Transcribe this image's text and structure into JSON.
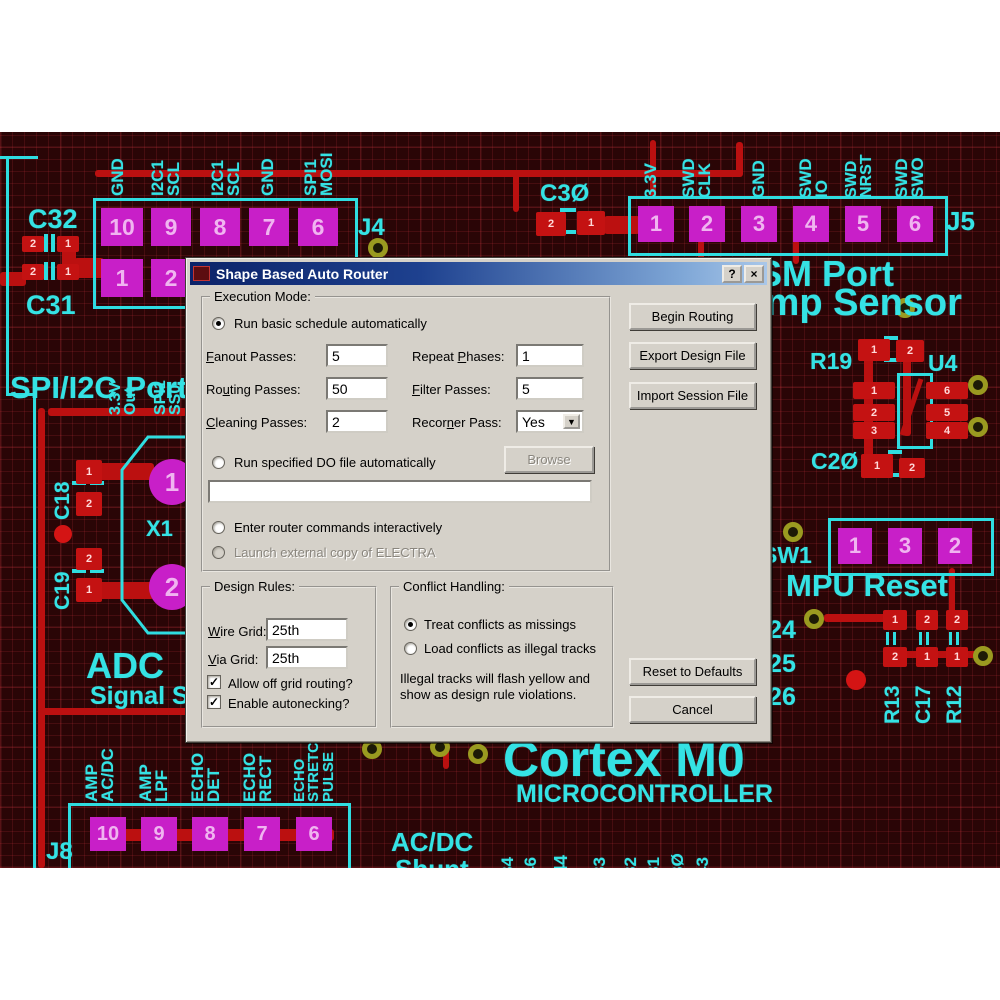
{
  "dialog": {
    "title": "Shape Based Auto Router",
    "help_glyph": "?",
    "close_glyph": "×",
    "check_glyph": "✓",
    "arrow_glyph": "▼",
    "exec": {
      "legend": "Execution Mode:",
      "radio_basic": "Run basic schedule automatically",
      "basic_selected": true,
      "fanout_label": "&Fanout Passes:",
      "fanout_value": "5",
      "repeat_label": "Repeat &Phases:",
      "repeat_value": "1",
      "routing_label": "Ro&uting Passes:",
      "routing_value": "50",
      "filter_label": "&Filter Passes:",
      "filter_value": "5",
      "cleaning_label": "&Cleaning Passes:",
      "cleaning_value": "2",
      "recorner_label": "Recor&ner Pass:",
      "recorner_value": "Yes",
      "radio_dofile": "Run specified DO file automatically",
      "dofile_selected": false,
      "browse_label": "Browse",
      "dofile_value": "",
      "radio_interactive": "Enter router commands interactively",
      "interactive_selected": false,
      "radio_electra": "Launch external copy of ELECTRA",
      "electra_selected": false
    },
    "design_rules": {
      "legend": "Design Rules:",
      "wire_label": "&Wire Grid:",
      "wire_value": "25th",
      "via_label": "&Via Grid:",
      "via_value": "25th",
      "offgrid_label": "Allow off grid routing?",
      "offgrid_checked": true,
      "autoneck_label": "Enable autonecking?",
      "autoneck_checked": true
    },
    "conflict": {
      "legend": "Conflict Handling:",
      "radio_missings": "Treat conflicts as missings",
      "missings_selected": true,
      "radio_illegal": "Load conflicts as illegal tracks",
      "illegal_selected": false,
      "note1": "Illegal tracks will flash yellow and",
      "note2": "show as design rule violations."
    },
    "buttons": {
      "begin": "Begin Routing",
      "export": "Export Design File",
      "import": "Import Session File",
      "reset": "Reset to Defaults",
      "cancel": "Cancel"
    }
  },
  "pcb": {
    "colors": {
      "board": "#2a0506",
      "silk": "#35e2e4",
      "pad": "#c81fc8",
      "copper": "#bb1010",
      "via_ring": "#9a9a20"
    },
    "labels": [
      {
        "t": "C32",
        "x": 28,
        "y": 74,
        "s": 27
      },
      {
        "t": "C31",
        "x": 26,
        "y": 160,
        "s": 27
      },
      {
        "t": "J4",
        "x": 358,
        "y": 84,
        "s": 24
      },
      {
        "t": "C3Ø",
        "x": 540,
        "y": 50,
        "s": 24
      },
      {
        "t": "J5",
        "x": 946,
        "y": 76,
        "s": 26
      },
      {
        "t": "GSM Port",
        "x": 730,
        "y": 124,
        "s": 36,
        "w": 900
      },
      {
        "t": "Temp Sensor",
        "x": 724,
        "y": 152,
        "s": 38,
        "w": 900
      },
      {
        "t": "R19",
        "x": 810,
        "y": 218,
        "s": 23
      },
      {
        "t": "U4",
        "x": 928,
        "y": 220,
        "s": 23
      },
      {
        "t": "C2Ø",
        "x": 811,
        "y": 318,
        "s": 23
      },
      {
        "t": "SW1",
        "x": 762,
        "y": 412,
        "s": 23
      },
      {
        "t": "MPU Reset",
        "x": 786,
        "y": 438,
        "s": 31,
        "w": 900
      },
      {
        "t": "C24",
        "x": 750,
        "y": 486,
        "s": 25
      },
      {
        "t": "C25",
        "x": 750,
        "y": 520,
        "s": 25
      },
      {
        "t": "C26",
        "x": 750,
        "y": 553,
        "s": 25
      },
      {
        "t": "SPI/I2C Port",
        "x": 10,
        "y": 240,
        "s": 31,
        "w": 900
      },
      {
        "t": "X1",
        "x": 146,
        "y": 386,
        "s": 22
      },
      {
        "t": "ADC",
        "x": 86,
        "y": 516,
        "s": 36,
        "w": 900
      },
      {
        "t": "Signal Source",
        "x": 90,
        "y": 552,
        "s": 25,
        "w": 900
      },
      {
        "t": "Cortex M0",
        "x": 503,
        "y": 602,
        "s": 50,
        "w": 900
      },
      {
        "t": "MICROCONTROLLER",
        "x": 516,
        "y": 650,
        "s": 25,
        "w": 900
      },
      {
        "t": "AC/DC",
        "x": 391,
        "y": 697,
        "s": 26,
        "w": 900
      },
      {
        "t": "Shunt",
        "x": 395,
        "y": 724,
        "s": 26,
        "w": 900
      },
      {
        "t": "J8",
        "x": 46,
        "y": 708,
        "s": 24
      }
    ],
    "vlabels": [
      {
        "t": "GND",
        "x": 110,
        "y": 64,
        "s": 17
      },
      {
        "t": "I2C1\nSCL",
        "x": 150,
        "y": 64,
        "s": 17
      },
      {
        "t": "I2C1\nSCL",
        "x": 210,
        "y": 64,
        "s": 17
      },
      {
        "t": "GND",
        "x": 260,
        "y": 64,
        "s": 17
      },
      {
        "t": "SPI1\nMOSI",
        "x": 303,
        "y": 64,
        "s": 17
      },
      {
        "t": "3.3V",
        "x": 643,
        "y": 66,
        "s": 17
      },
      {
        "t": "SWD\nCLK",
        "x": 681,
        "y": 66,
        "s": 17
      },
      {
        "t": "GND",
        "x": 751,
        "y": 66,
        "s": 17
      },
      {
        "t": "SWD\nIO",
        "x": 798,
        "y": 66,
        "s": 17
      },
      {
        "t": "SWD\nNRST",
        "x": 844,
        "y": 66,
        "s": 16
      },
      {
        "t": "SWD\nSWO",
        "x": 894,
        "y": 66,
        "s": 17
      },
      {
        "t": "3.3V\nOut",
        "x": 108,
        "y": 283,
        "s": 16
      },
      {
        "t": "SPI1\nSS0",
        "x": 153,
        "y": 283,
        "s": 16
      },
      {
        "t": "C18",
        "x": 53,
        "y": 388,
        "s": 21
      },
      {
        "t": "C19",
        "x": 53,
        "y": 478,
        "s": 21
      },
      {
        "t": "R13",
        "x": 883,
        "y": 592,
        "s": 21
      },
      {
        "t": "C17",
        "x": 914,
        "y": 592,
        "s": 21
      },
      {
        "t": "R12",
        "x": 945,
        "y": 592,
        "s": 21
      },
      {
        "t": "AMP\nAC/DC",
        "x": 84,
        "y": 670,
        "s": 17
      },
      {
        "t": "AMP\nLPF",
        "x": 138,
        "y": 670,
        "s": 17
      },
      {
        "t": "ECHO\nDET",
        "x": 190,
        "y": 670,
        "s": 17
      },
      {
        "t": "ECHO\nRECT",
        "x": 242,
        "y": 670,
        "s": 17
      },
      {
        "t": "ECHO\nSTRETCH\nPULSE",
        "x": 293,
        "y": 670,
        "s": 15
      },
      {
        "t": "34",
        "x": 500,
        "y": 744,
        "s": 17
      },
      {
        "t": "46",
        "x": 523,
        "y": 744,
        "s": 17
      },
      {
        "t": "C44",
        "x": 553,
        "y": 756,
        "s": 18
      },
      {
        "t": "33",
        "x": 592,
        "y": 744,
        "s": 17
      },
      {
        "t": "32",
        "x": 623,
        "y": 744,
        "s": 17
      },
      {
        "t": "31",
        "x": 646,
        "y": 744,
        "s": 17
      },
      {
        "t": "3Ø",
        "x": 670,
        "y": 744,
        "s": 17
      },
      {
        "t": "43",
        "x": 695,
        "y": 744,
        "s": 17
      }
    ],
    "pads": [
      {
        "t": "10",
        "x": 101,
        "y": 76,
        "w": 42,
        "h": 38
      },
      {
        "t": "9",
        "x": 151,
        "y": 76,
        "w": 40,
        "h": 38
      },
      {
        "t": "8",
        "x": 200,
        "y": 76,
        "w": 40,
        "h": 38
      },
      {
        "t": "7",
        "x": 249,
        "y": 76,
        "w": 40,
        "h": 38
      },
      {
        "t": "6",
        "x": 298,
        "y": 76,
        "w": 40,
        "h": 38
      },
      {
        "t": "1",
        "x": 101,
        "y": 127,
        "w": 42,
        "h": 38
      },
      {
        "t": "2",
        "x": 151,
        "y": 127,
        "w": 40,
        "h": 38
      },
      {
        "t": "1",
        "x": 638,
        "y": 74,
        "w": 36,
        "h": 36
      },
      {
        "t": "2",
        "x": 689,
        "y": 74,
        "w": 36,
        "h": 36
      },
      {
        "t": "3",
        "x": 741,
        "y": 74,
        "w": 36,
        "h": 36
      },
      {
        "t": "4",
        "x": 793,
        "y": 74,
        "w": 36,
        "h": 36
      },
      {
        "t": "5",
        "x": 845,
        "y": 74,
        "w": 36,
        "h": 36
      },
      {
        "t": "6",
        "x": 897,
        "y": 74,
        "w": 36,
        "h": 36
      },
      {
        "t": "1",
        "x": 838,
        "y": 396,
        "w": 34,
        "h": 36
      },
      {
        "t": "3",
        "x": 888,
        "y": 396,
        "w": 34,
        "h": 36
      },
      {
        "t": "2",
        "x": 938,
        "y": 396,
        "w": 34,
        "h": 36
      },
      {
        "t": "10",
        "x": 90,
        "y": 685,
        "w": 36,
        "h": 34
      },
      {
        "t": "9",
        "x": 141,
        "y": 685,
        "w": 36,
        "h": 34
      },
      {
        "t": "8",
        "x": 192,
        "y": 685,
        "w": 36,
        "h": 34
      },
      {
        "t": "7",
        "x": 244,
        "y": 685,
        "w": 36,
        "h": 34
      },
      {
        "t": "6",
        "x": 296,
        "y": 685,
        "w": 36,
        "h": 34
      }
    ],
    "circle_pads": [
      {
        "t": "1",
        "x": 172,
        "y": 350,
        "r": 23
      },
      {
        "t": "2",
        "x": 172,
        "y": 455,
        "r": 23
      }
    ],
    "red_pads": [
      {
        "t": "2",
        "x": 22,
        "y": 104,
        "w": 22,
        "h": 16
      },
      {
        "t": "1",
        "x": 57,
        "y": 104,
        "w": 22,
        "h": 16
      },
      {
        "t": "2",
        "x": 22,
        "y": 132,
        "w": 22,
        "h": 16
      },
      {
        "t": "1",
        "x": 57,
        "y": 132,
        "w": 22,
        "h": 16
      },
      {
        "t": "2",
        "x": 536,
        "y": 80,
        "w": 30,
        "h": 24
      },
      {
        "t": "1",
        "x": 577,
        "y": 79,
        "w": 28,
        "h": 24
      },
      {
        "t": "1",
        "x": 858,
        "y": 207,
        "w": 32,
        "h": 22
      },
      {
        "t": "2",
        "x": 896,
        "y": 208,
        "w": 28,
        "h": 22
      },
      {
        "t": "1",
        "x": 853,
        "y": 250,
        "w": 42,
        "h": 17
      },
      {
        "t": "2",
        "x": 853,
        "y": 272,
        "w": 42,
        "h": 17
      },
      {
        "t": "3",
        "x": 853,
        "y": 290,
        "w": 42,
        "h": 17
      },
      {
        "t": "6",
        "x": 926,
        "y": 250,
        "w": 42,
        "h": 17
      },
      {
        "t": "5",
        "x": 926,
        "y": 272,
        "w": 42,
        "h": 17
      },
      {
        "t": "4",
        "x": 926,
        "y": 290,
        "w": 42,
        "h": 17
      },
      {
        "t": "1",
        "x": 861,
        "y": 322,
        "w": 32,
        "h": 24
      },
      {
        "t": "2",
        "x": 899,
        "y": 326,
        "w": 26,
        "h": 20
      },
      {
        "t": "1",
        "x": 883,
        "y": 478,
        "w": 24,
        "h": 20
      },
      {
        "t": "2",
        "x": 916,
        "y": 478,
        "w": 22,
        "h": 20
      },
      {
        "t": "2",
        "x": 946,
        "y": 478,
        "w": 22,
        "h": 20
      },
      {
        "t": "2",
        "x": 883,
        "y": 515,
        "w": 24,
        "h": 20
      },
      {
        "t": "1",
        "x": 916,
        "y": 515,
        "w": 22,
        "h": 20
      },
      {
        "t": "1",
        "x": 946,
        "y": 515,
        "w": 22,
        "h": 20
      },
      {
        "t": "1",
        "x": 76,
        "y": 328,
        "w": 26,
        "h": 24
      },
      {
        "t": "2",
        "x": 76,
        "y": 360,
        "w": 26,
        "h": 24
      },
      {
        "t": "2",
        "x": 76,
        "y": 416,
        "w": 26,
        "h": 22
      },
      {
        "t": "1",
        "x": 76,
        "y": 446,
        "w": 26,
        "h": 24
      }
    ],
    "traces": [
      [
        95,
        38,
        647,
        7
      ],
      [
        736,
        10,
        7,
        35
      ],
      [
        513,
        38,
        6,
        42
      ],
      [
        62,
        112,
        14,
        24
      ],
      [
        74,
        126,
        30,
        20
      ],
      [
        0,
        140,
        26,
        14
      ],
      [
        604,
        84,
        36,
        18
      ],
      [
        698,
        108,
        6,
        20
      ],
      [
        793,
        108,
        6,
        24
      ],
      [
        650,
        8,
        6,
        58
      ],
      [
        864,
        223,
        9,
        102
      ],
      [
        903,
        214,
        8,
        90
      ],
      [
        949,
        436,
        6,
        48
      ],
      [
        824,
        482,
        64,
        8
      ],
      [
        883,
        519,
        100,
        7
      ],
      [
        48,
        276,
        139,
        8
      ],
      [
        38,
        276,
        7,
        460
      ],
      [
        38,
        576,
        165,
        7
      ],
      [
        98,
        331,
        56,
        17
      ],
      [
        98,
        450,
        56,
        17
      ],
      [
        90,
        697,
        244,
        12
      ],
      [
        443,
        611,
        6,
        26
      ]
    ],
    "outlines": [
      [
        93,
        66,
        259,
        105
      ],
      [
        628,
        64,
        314,
        54
      ],
      [
        828,
        386,
        160,
        52
      ],
      [
        68,
        671,
        277,
        80
      ],
      [
        897,
        241,
        30,
        70
      ]
    ],
    "cyan_marks": [
      [
        44,
        102,
        4,
        18
      ],
      [
        51,
        102,
        4,
        18
      ],
      [
        44,
        130,
        4,
        18
      ],
      [
        51,
        130,
        4,
        18
      ],
      [
        560,
        76,
        16,
        4
      ],
      [
        560,
        98,
        16,
        4
      ],
      [
        884,
        204,
        14,
        4
      ],
      [
        884,
        226,
        14,
        4
      ],
      [
        888,
        318,
        14,
        4
      ],
      [
        888,
        341,
        14,
        4
      ],
      [
        72,
        349,
        14,
        4
      ],
      [
        90,
        349,
        14,
        4
      ],
      [
        72,
        437,
        14,
        4
      ],
      [
        90,
        437,
        14,
        4
      ],
      [
        886,
        500,
        3,
        13
      ],
      [
        893,
        500,
        3,
        13
      ],
      [
        919,
        500,
        3,
        13
      ],
      [
        926,
        500,
        3,
        13
      ],
      [
        949,
        500,
        3,
        13
      ],
      [
        956,
        500,
        3,
        13
      ],
      [
        0,
        24,
        38,
        3
      ],
      [
        6,
        24,
        3,
        240
      ],
      [
        6,
        261,
        30,
        3
      ],
      [
        33,
        261,
        3,
        475
      ]
    ],
    "vias": [
      [
        378,
        116
      ],
      [
        905,
        176
      ],
      [
        978,
        253
      ],
      [
        978,
        295
      ],
      [
        793,
        400
      ],
      [
        814,
        487
      ],
      [
        983,
        524
      ],
      [
        372,
        617
      ],
      [
        440,
        615
      ],
      [
        478,
        622
      ]
    ],
    "dots": [
      [
        63,
        402,
        9
      ],
      [
        856,
        548,
        10
      ]
    ]
  }
}
